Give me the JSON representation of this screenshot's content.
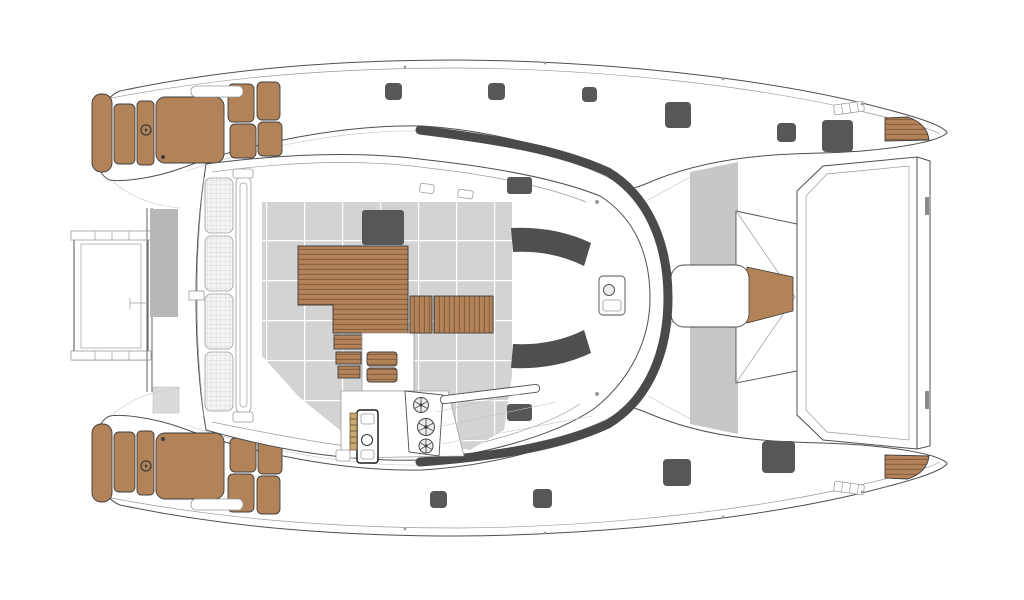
{
  "diagram": {
    "label": "Catamaran yacht deck plan, top view",
    "type": "deck-plan",
    "colors": {
      "line": "#4f4f4f",
      "line_light": "#9b9b9b",
      "line_faint": "#c2c2c2",
      "teak": "#b28258",
      "teak_slat": "#86613f",
      "teak_edge": "#3d3d3d",
      "floor": "#d3d3d3",
      "grout": "#ffffff",
      "strip_gray": "#c7c7c7",
      "beam_gray": "#b7b7b7",
      "light_sq": "#dadada",
      "dark": "#575757",
      "seat": "#4f4f4f",
      "band": "#4a4a4a",
      "quilt_bg": "#f4f4f4",
      "quilt_grid": "#d2d2d2"
    },
    "deck_hatches": [
      {
        "x": 385,
        "y": 83,
        "w": 17,
        "h": 17
      },
      {
        "x": 488,
        "y": 83,
        "w": 17,
        "h": 17
      },
      {
        "x": 582,
        "y": 87,
        "w": 15,
        "h": 15
      },
      {
        "x": 665,
        "y": 102,
        "w": 26,
        "h": 26
      },
      {
        "x": 777,
        "y": 123,
        "w": 19,
        "h": 19
      },
      {
        "x": 822,
        "y": 120,
        "w": 31,
        "h": 32
      },
      {
        "x": 430,
        "y": 491,
        "w": 17,
        "h": 17
      },
      {
        "x": 533,
        "y": 489,
        "w": 19,
        "h": 19
      },
      {
        "x": 663,
        "y": 459,
        "w": 28,
        "h": 27
      },
      {
        "x": 762,
        "y": 441,
        "w": 33,
        "h": 32
      }
    ],
    "components": [
      "port-hull",
      "starboard-hull",
      "bow-sunpads",
      "bow-platform",
      "forward-crossbeam",
      "saloon-pod",
      "quilted-sunpad",
      "hatch-track",
      "saloon-floor",
      "saloon-table",
      "teak-benches",
      "lounge-seats",
      "galley-block",
      "windshield-band",
      "helm-station",
      "winches",
      "throttle-console",
      "nav-pod-console",
      "aft-walkway",
      "transom-seat",
      "aft-bench",
      "swim-platform",
      "stern-teak-steps",
      "deck-hatches"
    ]
  }
}
